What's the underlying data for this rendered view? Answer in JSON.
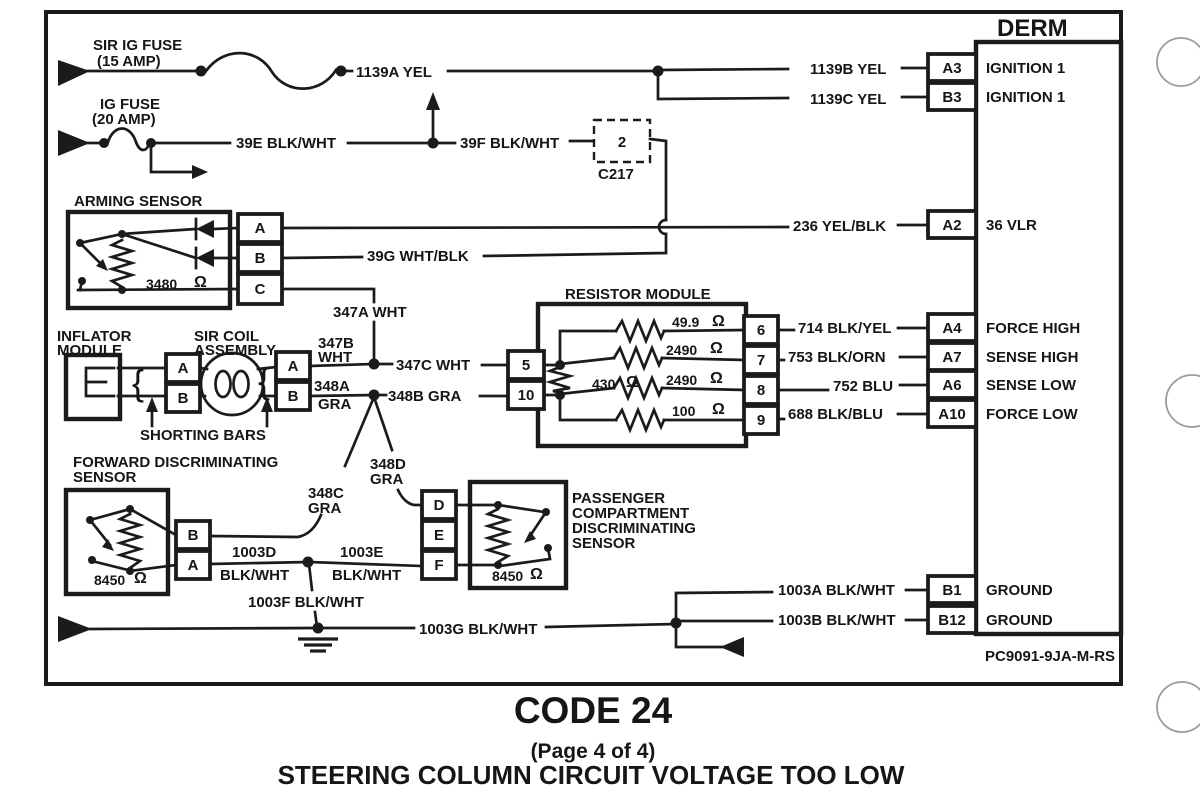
{
  "header": {
    "derm": "DERM"
  },
  "footer": {
    "part_number": "PC9091-9JA-M-RS",
    "code": "CODE 24",
    "page": "(Page 4 of 4)",
    "title": "STEERING COLUMN CIRCUIT VOLTAGE TOO LOW"
  },
  "fuses": {
    "sir_ig": {
      "name": "SIR IG FUSE",
      "rating": "(15 AMP)"
    },
    "ig": {
      "name": "IG FUSE",
      "rating": "(20 AMP)"
    }
  },
  "c217": {
    "pin": "2",
    "name": "C217"
  },
  "arming_sensor": {
    "label": "ARMING SENSOR",
    "resistance": "3480",
    "ohm": "Ω",
    "pin_a": "A",
    "pin_b": "B",
    "pin_c": "C"
  },
  "inflator": {
    "line1": "INFLATOR",
    "line2": "MODULE"
  },
  "sir_coil": {
    "line1": "SIR COIL",
    "line2": "ASSEMBLY",
    "pin_a1": "A",
    "pin_b1": "B",
    "pin_a2": "A",
    "pin_b2": "B"
  },
  "shorting_bars": {
    "label": "SHORTING BARS",
    "brace": "{"
  },
  "resistor_module": {
    "label": "RESISTOR MODULE",
    "p5": "5",
    "p10": "10",
    "p6": "6",
    "p7": "7",
    "p8": "8",
    "p9": "9",
    "r49_9": "49.9",
    "r2490a": "2490",
    "r430": "430",
    "r2490b": "2490",
    "r100": "100",
    "ohm": "Ω"
  },
  "forward_sensor": {
    "line1": "FORWARD DISCRIMINATING",
    "line2": "SENSOR",
    "resistance": "8450",
    "ohm": "Ω",
    "pin_b": "B",
    "pin_a": "A"
  },
  "passenger_sensor": {
    "line1": "PASSENGER",
    "line2": "COMPARTMENT",
    "line3": "DISCRIMINATING",
    "line4": "SENSOR",
    "resistance": "8450",
    "ohm": "Ω",
    "pin_d": "D",
    "pin_e": "E",
    "pin_f": "F"
  },
  "derm_pins": {
    "a3": {
      "pin": "A3",
      "signal": "IGNITION 1",
      "wire": "1139B YEL"
    },
    "b3": {
      "pin": "B3",
      "signal": "IGNITION 1",
      "wire": "1139C YEL"
    },
    "a2": {
      "pin": "A2",
      "signal": "36 VLR",
      "wire": "236 YEL/BLK"
    },
    "a4": {
      "pin": "A4",
      "signal": "FORCE HIGH",
      "wire": "714 BLK/YEL"
    },
    "a7": {
      "pin": "A7",
      "signal": "SENSE HIGH",
      "wire": "753 BLK/ORN"
    },
    "a6": {
      "pin": "A6",
      "signal": "SENSE LOW",
      "wire": "752 BLU"
    },
    "a10": {
      "pin": "A10",
      "signal": "FORCE LOW",
      "wire": "688 BLK/BLU"
    },
    "b1": {
      "pin": "B1",
      "signal": "GROUND",
      "wire": "1003A BLK/WHT"
    },
    "b12": {
      "pin": "B12",
      "signal": "GROUND",
      "wire": "1003B BLK/WHT"
    }
  },
  "wires": {
    "w1139a": "1139A YEL",
    "w39e": "39E BLK/WHT",
    "w39f": "39F BLK/WHT",
    "w39g": "39G WHT/BLK",
    "w347a": "347A WHT",
    "w347b_l1": "347B",
    "w347b_l2": "WHT",
    "w347c": "347C WHT",
    "w348a_l1": "348A",
    "w348a_l2": "GRA",
    "w348b": "348B GRA",
    "w348c_l1": "348C",
    "w348c_l2": "GRA",
    "w348d_l1": "348D",
    "w348d_l2": "GRA",
    "w1003d_l1": "1003D",
    "w1003d_l2": "BLK/WHT",
    "w1003e_l1": "1003E",
    "w1003e_l2": "BLK/WHT",
    "w1003f": "1003F BLK/WHT",
    "w1003g": "1003G BLK/WHT"
  }
}
